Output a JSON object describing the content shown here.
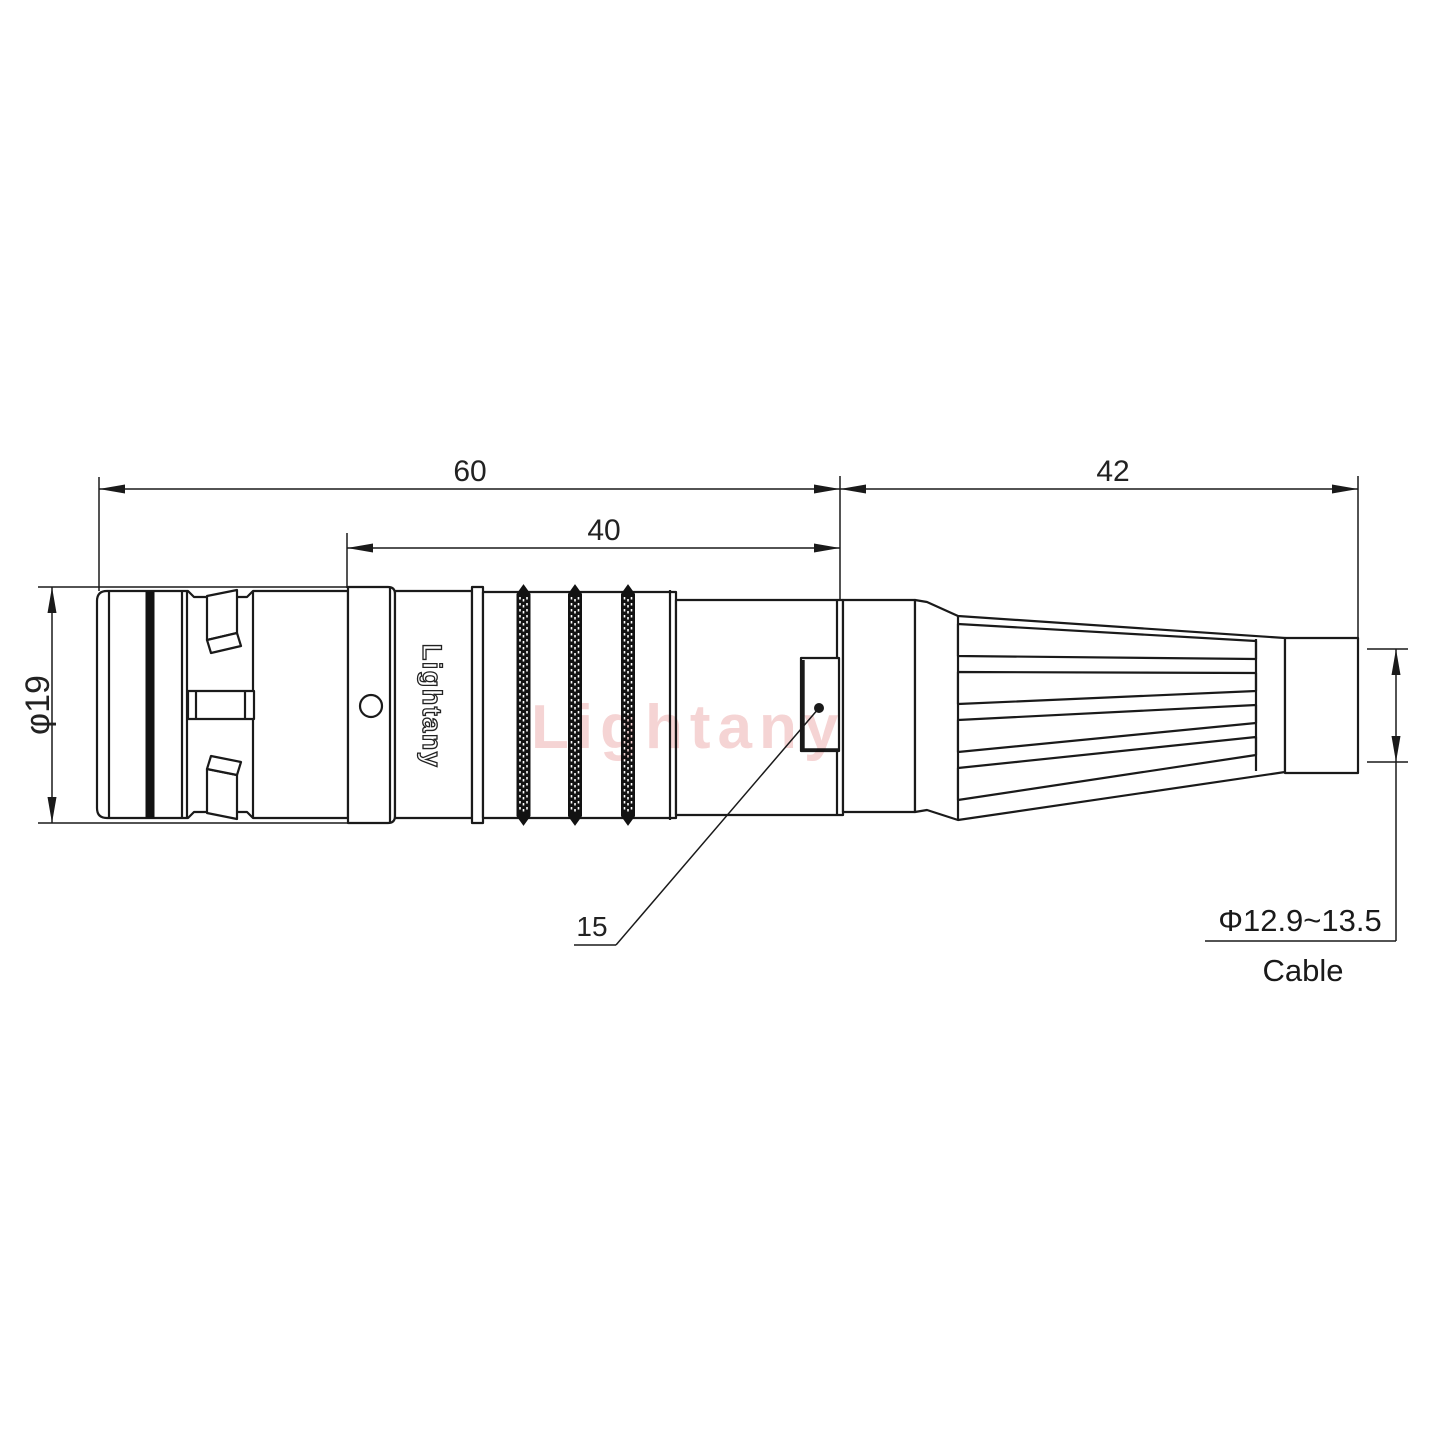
{
  "watermark_text": "Lightany",
  "connector": {
    "shell_marking": "Lightany"
  },
  "dimensions": {
    "front_length": "60",
    "mid_length": "40",
    "boot_length": "42",
    "shell_diameter": "φ19",
    "key_position": "15",
    "cable_diameter_range": "Φ12.9~13.5",
    "cable_caption": "Cable"
  },
  "colors": {
    "line": "#1a1a1a",
    "watermark_pink": "#edb0b0"
  }
}
